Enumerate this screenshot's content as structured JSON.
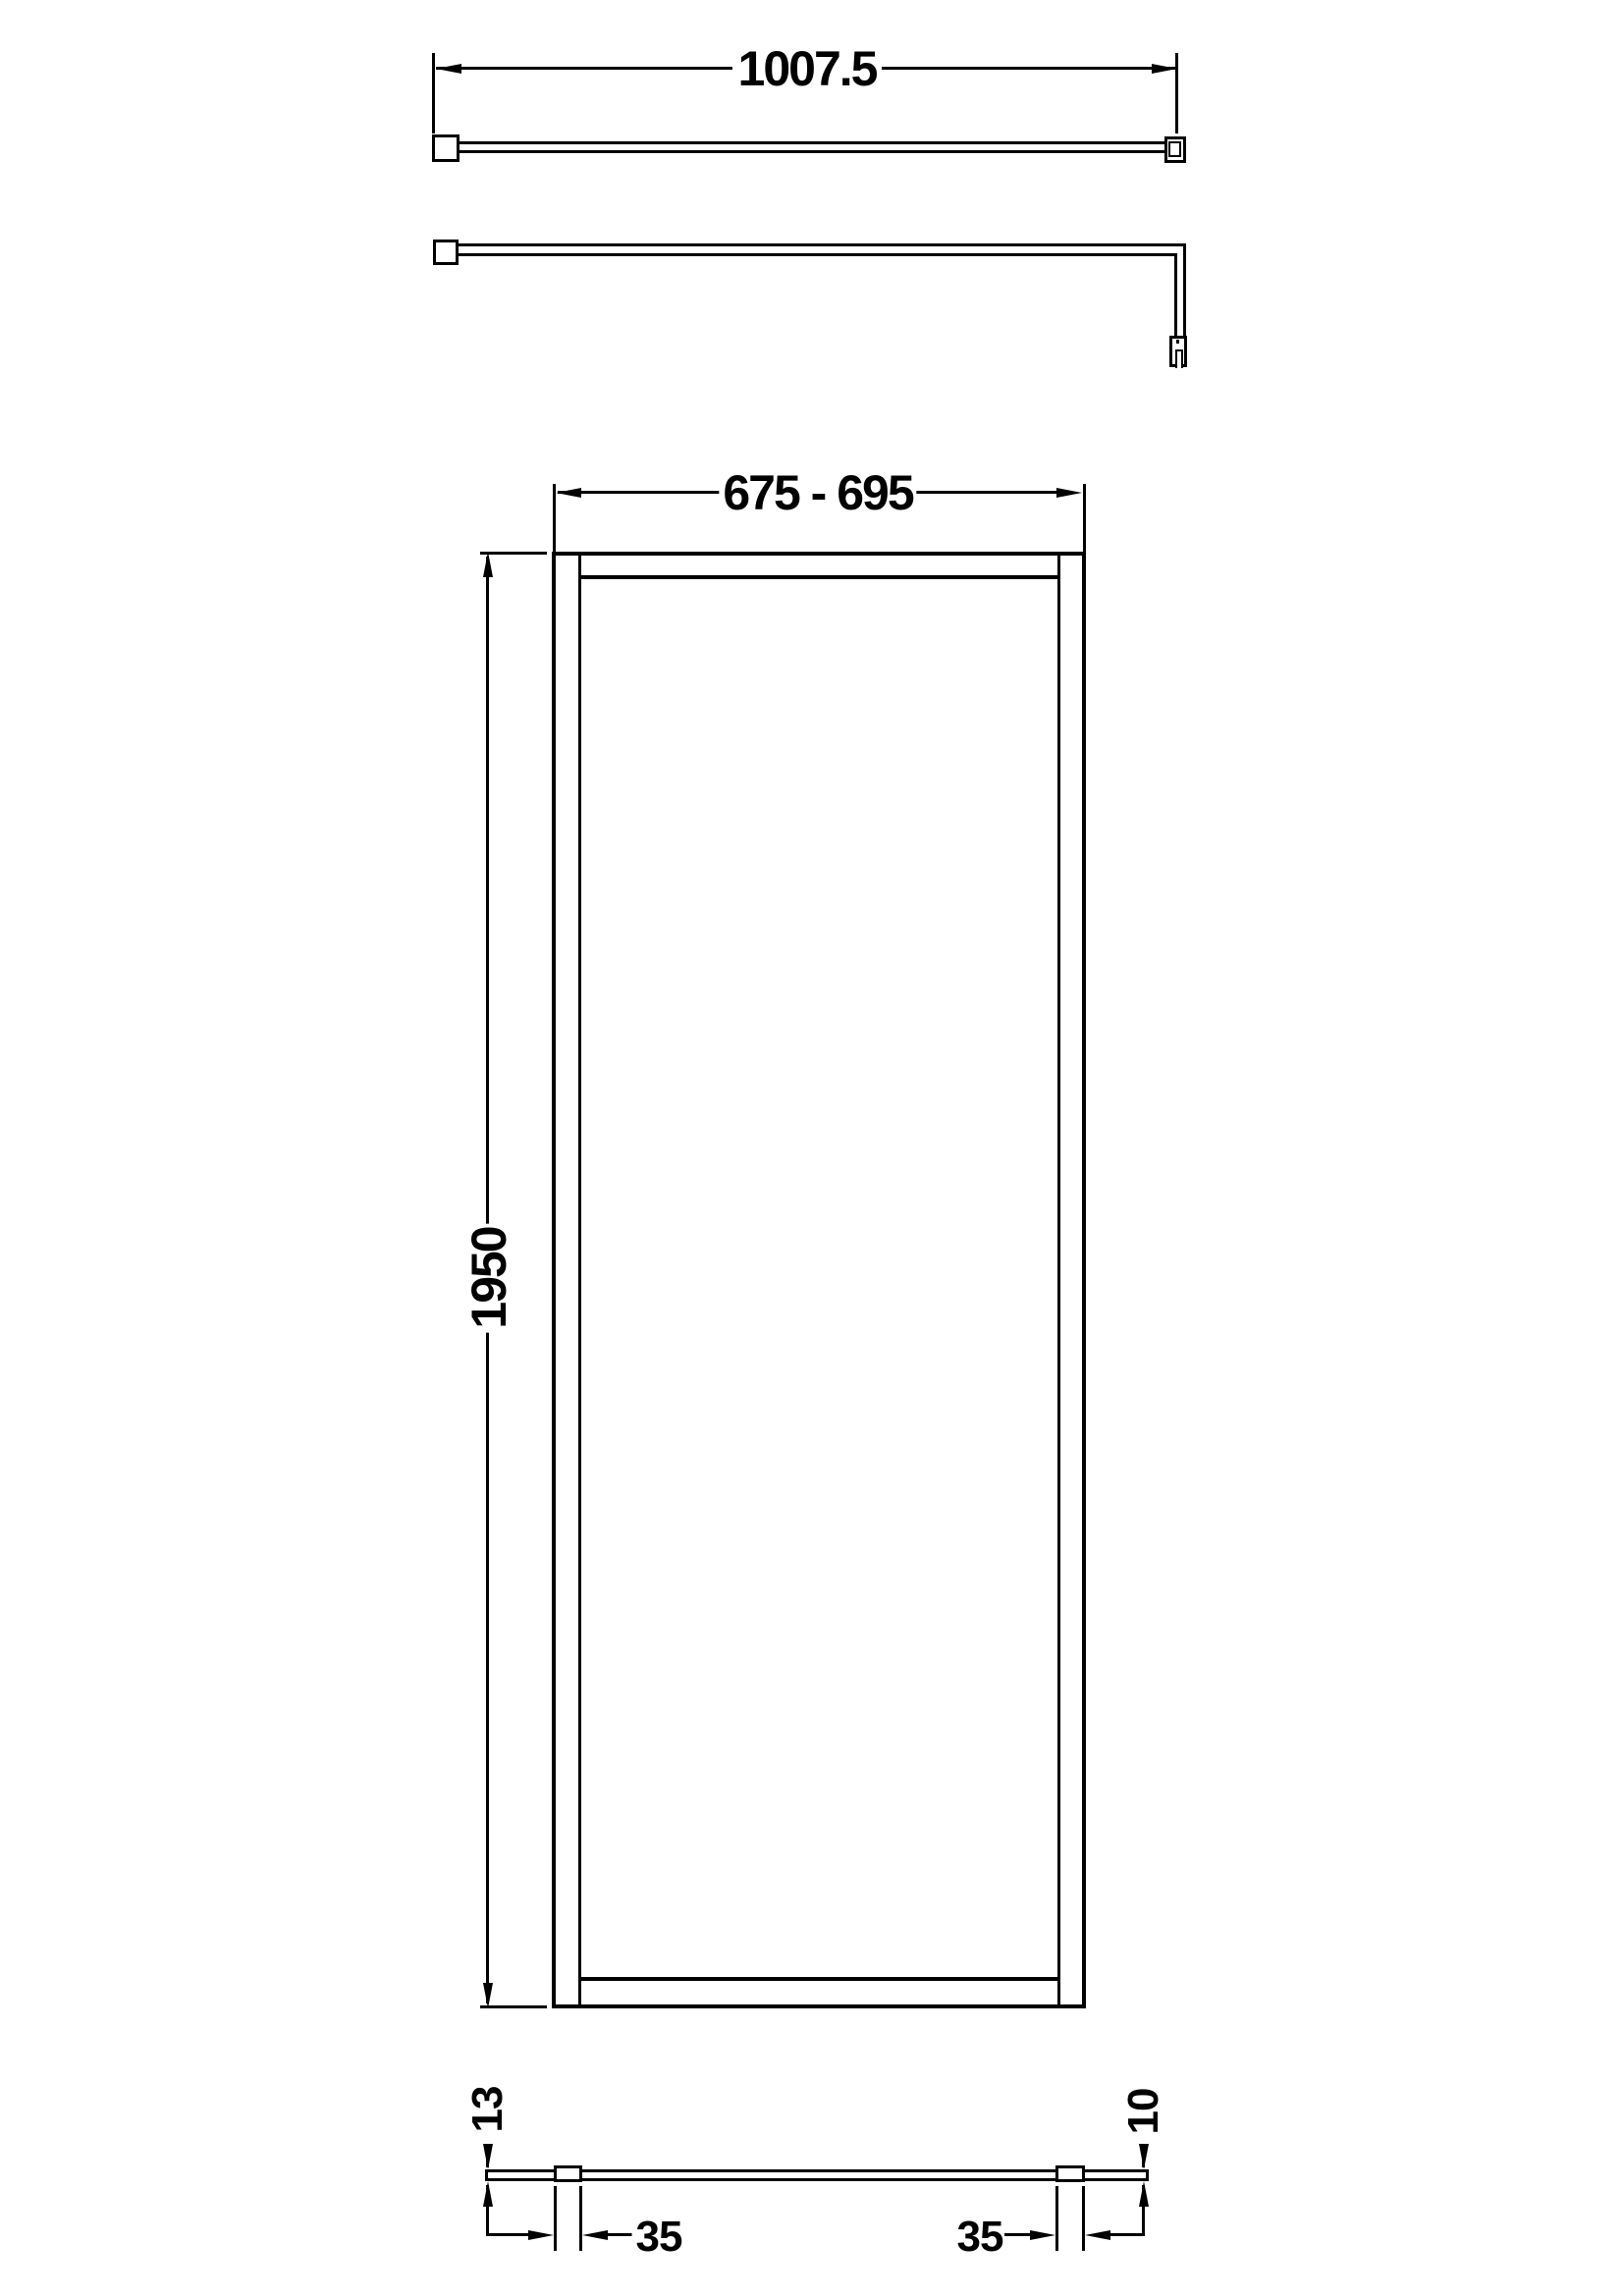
{
  "drawing": {
    "colors": {
      "ink": "#000000",
      "background": "#ffffff"
    },
    "top_view": {
      "length_dim": "1007.5"
    },
    "front_view": {
      "width_dim": "675 - 695",
      "height_dim": "1950"
    },
    "bottom_view": {
      "left_depth_dim": "13",
      "right_depth_dim": "10",
      "left_profile_dim": "35",
      "right_profile_dim": "35"
    }
  }
}
